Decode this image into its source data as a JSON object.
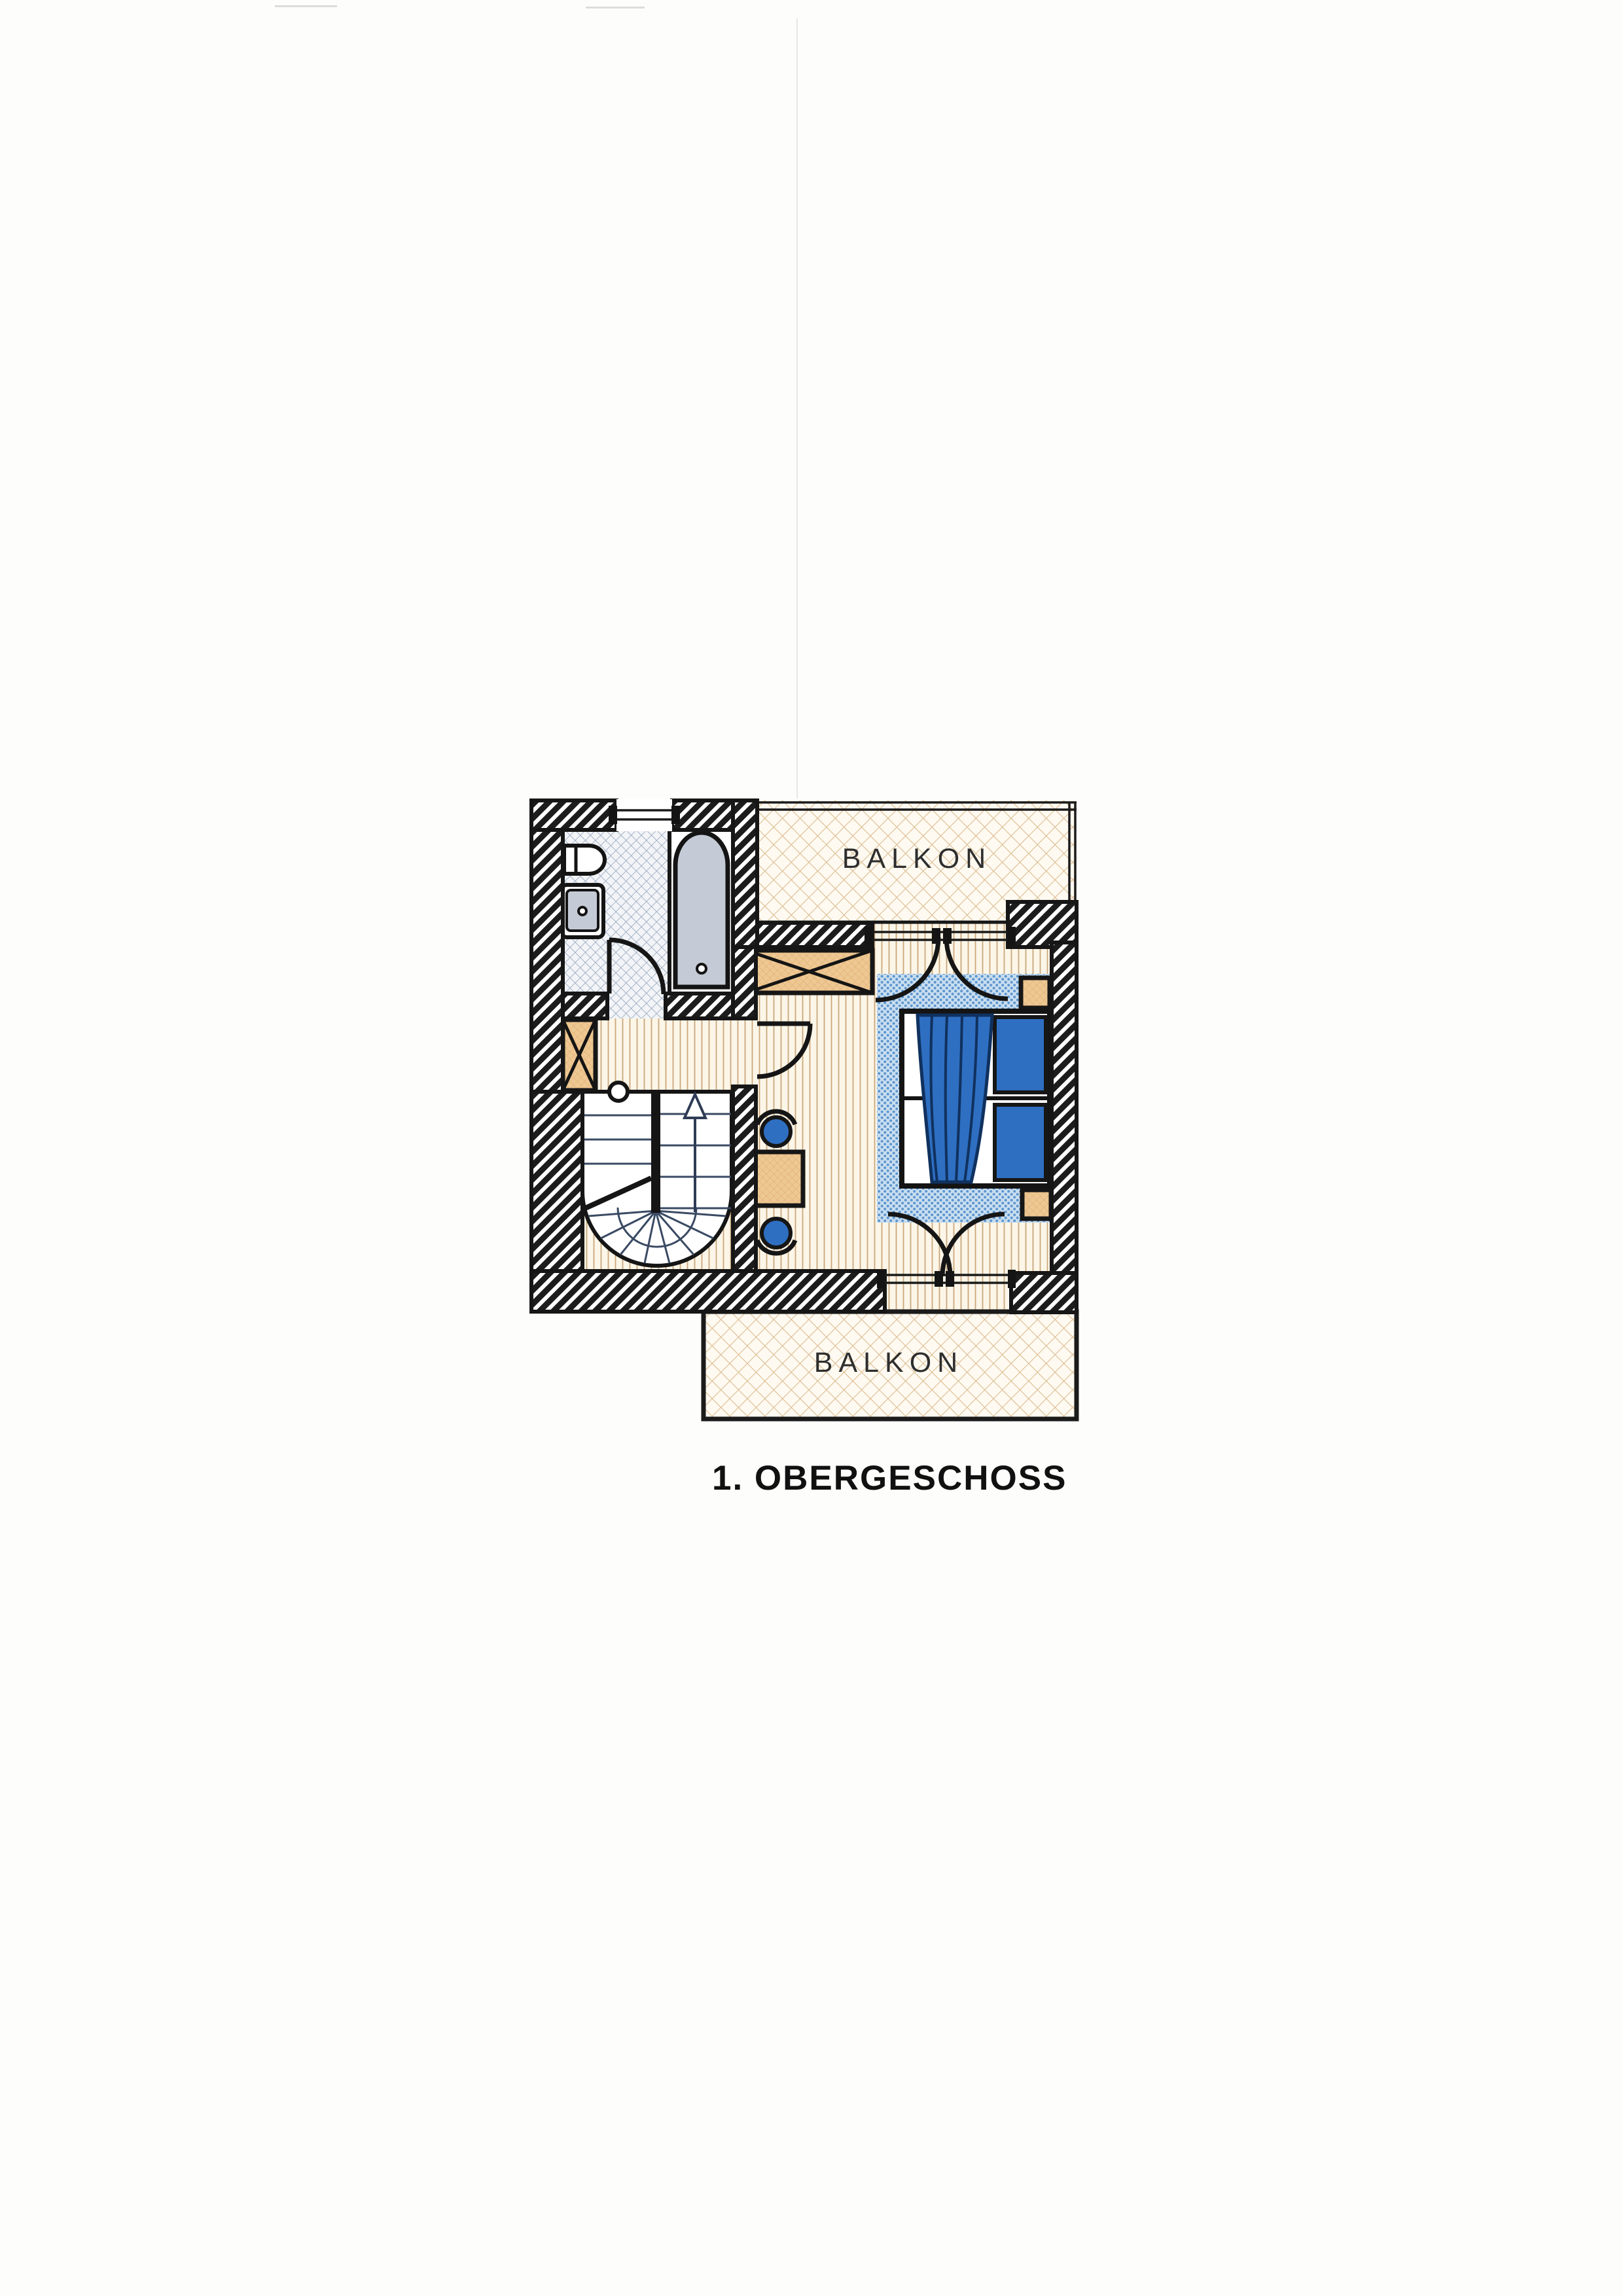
{
  "document": {
    "page_background": "#fdfdfb"
  },
  "plan": {
    "title": "1. OBERGESCHOSS",
    "balcony_top_label": "BALKON",
    "balcony_bottom_label": "BALKON",
    "colors": {
      "wall": "#1c1c1c",
      "line": "#161616",
      "floor_bg": "#fcf6e8",
      "floor_line": "#c9a87c",
      "balcony_bg": "#fefaf1",
      "balcony_line": "#dcbd92",
      "tile_bg": "#f2f4f7",
      "tile_line": "#9aaabf",
      "carpet_bg": "#cbdff0",
      "carpet_dot": "#5e97cf",
      "furniture_tan": "#eec893",
      "furniture_tan_line": "#dfae72",
      "fixture_gray": "#c5cbd6",
      "accent_blue": "#2e6fc2"
    }
  }
}
